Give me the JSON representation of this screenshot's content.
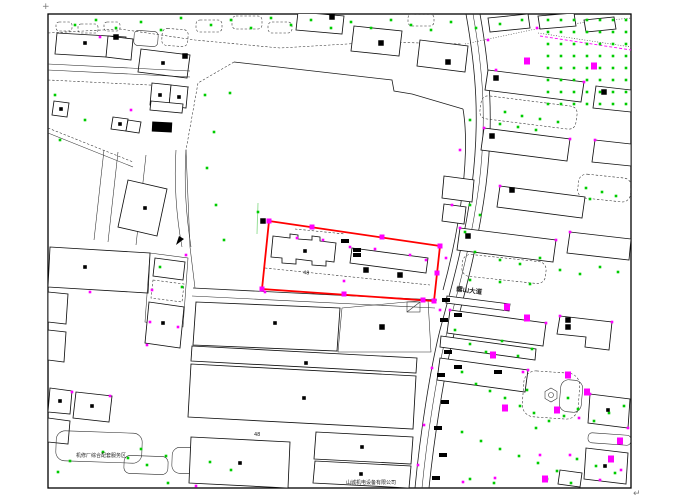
{
  "colors": {
    "background": "#ffffff",
    "line": "#1c1c1c",
    "parcel_red": "#ff0000",
    "tree_green": "#00cc00",
    "faint_green": "#8fdc8f",
    "marker_magenta": "#ff00ff",
    "text_dark": "#222222"
  },
  "labels": {
    "corner_plus": "+",
    "corner_return": "↵",
    "road_name": "螺山大道",
    "dim_a": "48",
    "dim_b": "48",
    "text_bottom_left": "机修厂综合配套服务区",
    "text_bottom_center": "山城机电设备有限公司"
  },
  "map": {
    "red_parcel": {
      "points_str": "269,221 440,246 434,301 262,289",
      "grips": [
        [
          269,
          221
        ],
        [
          312,
          227
        ],
        [
          382,
          237
        ],
        [
          440,
          246
        ],
        [
          437,
          273
        ],
        [
          434,
          301
        ],
        [
          423,
          300
        ],
        [
          344,
          294
        ],
        [
          262,
          289
        ]
      ]
    },
    "green_dots": [
      [
        548,
        20
      ],
      [
        561,
        20
      ],
      [
        574,
        20
      ],
      [
        587,
        20
      ],
      [
        600,
        20
      ],
      [
        613,
        20
      ],
      [
        626,
        20
      ],
      [
        548,
        32
      ],
      [
        561,
        32
      ],
      [
        574,
        32
      ],
      [
        587,
        32
      ],
      [
        600,
        32
      ],
      [
        613,
        32
      ],
      [
        626,
        32
      ],
      [
        548,
        44
      ],
      [
        561,
        44
      ],
      [
        574,
        44
      ],
      [
        587,
        44
      ],
      [
        600,
        44
      ],
      [
        613,
        44
      ],
      [
        626,
        44
      ],
      [
        548,
        56
      ],
      [
        561,
        56
      ],
      [
        574,
        56
      ],
      [
        587,
        56
      ],
      [
        600,
        56
      ],
      [
        613,
        56
      ],
      [
        626,
        56
      ],
      [
        548,
        68
      ],
      [
        561,
        68
      ],
      [
        574,
        68
      ],
      [
        587,
        68
      ],
      [
        600,
        68
      ],
      [
        613,
        68
      ],
      [
        626,
        68
      ],
      [
        548,
        80
      ],
      [
        561,
        80
      ],
      [
        574,
        80
      ],
      [
        587,
        80
      ],
      [
        600,
        80
      ],
      [
        613,
        80
      ],
      [
        626,
        80
      ],
      [
        548,
        92
      ],
      [
        561,
        92
      ],
      [
        574,
        92
      ],
      [
        587,
        92
      ],
      [
        600,
        92
      ],
      [
        613,
        92
      ],
      [
        626,
        92
      ],
      [
        548,
        104
      ],
      [
        561,
        104
      ],
      [
        574,
        104
      ],
      [
        587,
        104
      ],
      [
        600,
        104
      ],
      [
        613,
        104
      ],
      [
        626,
        104
      ],
      [
        505,
        112
      ],
      [
        522,
        116
      ],
      [
        540,
        119
      ],
      [
        558,
        122
      ],
      [
        500,
        124
      ],
      [
        518,
        127
      ],
      [
        536,
        130
      ],
      [
        470,
        120
      ],
      [
        586,
        188
      ],
      [
        602,
        192
      ],
      [
        616,
        196
      ],
      [
        590,
        199
      ],
      [
        470,
        205
      ],
      [
        480,
        215
      ],
      [
        465,
        232
      ],
      [
        475,
        252
      ],
      [
        500,
        260
      ],
      [
        520,
        264
      ],
      [
        540,
        258
      ],
      [
        560,
        270
      ],
      [
        580,
        274
      ],
      [
        600,
        267
      ],
      [
        618,
        272
      ],
      [
        470,
        280
      ],
      [
        500,
        282
      ],
      [
        530,
        284
      ],
      [
        455,
        330
      ],
      [
        470,
        344
      ],
      [
        486,
        352
      ],
      [
        502,
        341
      ],
      [
        518,
        356
      ],
      [
        532,
        349
      ],
      [
        462,
        372
      ],
      [
        476,
        384
      ],
      [
        490,
        391
      ],
      [
        505,
        398
      ],
      [
        520,
        406
      ],
      [
        534,
        413
      ],
      [
        549,
        421
      ],
      [
        564,
        416
      ],
      [
        578,
        409
      ],
      [
        594,
        421
      ],
      [
        609,
        413
      ],
      [
        624,
        406
      ],
      [
        527,
        390
      ],
      [
        536,
        428
      ],
      [
        568,
        398
      ],
      [
        462,
        432
      ],
      [
        481,
        441
      ],
      [
        500,
        449
      ],
      [
        519,
        456
      ],
      [
        538,
        463
      ],
      [
        557,
        471
      ],
      [
        577,
        459
      ],
      [
        596,
        466
      ],
      [
        615,
        473
      ],
      [
        470,
        479
      ],
      [
        494,
        483
      ],
      [
        547,
        479
      ],
      [
        571,
        483
      ],
      [
        70,
        461
      ],
      [
        103,
        452
      ],
      [
        141,
        449
      ],
      [
        147,
        465
      ],
      [
        166,
        456
      ],
      [
        210,
        462
      ],
      [
        231,
        470
      ],
      [
        160,
        267
      ],
      [
        182,
        287
      ],
      [
        168,
        483
      ],
      [
        58,
        472
      ],
      [
        128,
        458
      ],
      [
        205,
        95
      ],
      [
        214,
        132
      ],
      [
        207,
        168
      ],
      [
        216,
        205
      ],
      [
        224,
        240
      ],
      [
        258,
        212
      ],
      [
        230,
        93
      ],
      [
        75,
        25
      ],
      [
        96,
        20
      ],
      [
        116,
        28
      ],
      [
        141,
        22
      ],
      [
        161,
        30
      ],
      [
        181,
        18
      ],
      [
        211,
        25
      ],
      [
        231,
        20
      ],
      [
        251,
        28
      ],
      [
        271,
        18
      ],
      [
        291,
        25
      ],
      [
        311,
        20
      ],
      [
        331,
        28
      ],
      [
        351,
        22
      ],
      [
        371,
        28
      ],
      [
        391,
        20
      ],
      [
        411,
        25
      ],
      [
        431,
        30
      ],
      [
        451,
        22
      ],
      [
        476,
        28
      ],
      [
        500,
        24
      ],
      [
        522,
        20
      ],
      [
        55,
        95
      ],
      [
        85,
        120
      ],
      [
        60,
        140
      ]
    ],
    "magenta_ticks": [
      [
        297,
        238
      ],
      [
        323,
        240
      ],
      [
        375,
        249
      ],
      [
        410,
        255
      ],
      [
        350,
        247
      ],
      [
        426,
        260
      ],
      [
        265,
        292
      ],
      [
        488,
        40
      ],
      [
        537,
        28
      ],
      [
        460,
        150
      ],
      [
        452,
        205
      ],
      [
        446,
        258
      ],
      [
        440,
        310
      ],
      [
        432,
        368
      ],
      [
        424,
        425
      ],
      [
        418,
        465
      ],
      [
        496,
        70
      ],
      [
        584,
        82
      ],
      [
        484,
        128
      ],
      [
        570,
        139
      ],
      [
        595,
        140
      ],
      [
        500,
        186
      ],
      [
        460,
        228
      ],
      [
        556,
        240
      ],
      [
        570,
        232
      ],
      [
        450,
        310
      ],
      [
        546,
        323
      ],
      [
        528,
        370
      ],
      [
        560,
        316
      ],
      [
        612,
        322
      ],
      [
        523,
        372
      ],
      [
        579,
        418
      ],
      [
        590,
        394
      ],
      [
        628,
        428
      ],
      [
        152,
        290
      ],
      [
        186,
        255
      ],
      [
        90,
        292
      ],
      [
        150,
        322
      ],
      [
        100,
        37
      ],
      [
        131,
        110
      ],
      [
        178,
        327
      ],
      [
        147,
        345
      ],
      [
        110,
        396
      ],
      [
        72,
        392
      ],
      [
        540,
        455
      ],
      [
        570,
        455
      ],
      [
        600,
        480
      ],
      [
        621,
        470
      ],
      [
        495,
        478
      ],
      [
        463,
        482
      ],
      [
        196,
        486
      ],
      [
        344,
        281
      ]
    ],
    "magenta_blobs": [
      [
        594,
        66
      ],
      [
        527,
        61
      ],
      [
        507,
        307
      ],
      [
        527,
        318
      ],
      [
        493,
        355
      ],
      [
        568,
        375
      ],
      [
        587,
        392
      ],
      [
        557,
        410
      ],
      [
        505,
        408
      ],
      [
        620,
        441
      ],
      [
        611,
        459
      ],
      [
        545,
        479
      ]
    ],
    "black_dots": [
      [
        85,
        43
      ],
      [
        163,
        63
      ],
      [
        61,
        109
      ],
      [
        160,
        95
      ],
      [
        179,
        97
      ],
      [
        120,
        124
      ],
      [
        145,
        208
      ],
      [
        85,
        267
      ],
      [
        92,
        406
      ],
      [
        60,
        401
      ],
      [
        163,
        323
      ],
      [
        275,
        323
      ],
      [
        306,
        363
      ],
      [
        304,
        398
      ],
      [
        240,
        463
      ],
      [
        362,
        447
      ],
      [
        361,
        474
      ],
      [
        305,
        251
      ],
      [
        608,
        410
      ],
      [
        605,
        466
      ]
    ],
    "black_squares": [
      [
        116,
        37
      ],
      [
        185,
        56
      ],
      [
        332,
        17
      ],
      [
        381,
        43
      ],
      [
        448,
        62
      ],
      [
        496,
        78
      ],
      [
        604,
        92
      ],
      [
        492,
        136
      ],
      [
        468,
        236
      ],
      [
        263,
        221
      ],
      [
        366,
        270
      ],
      [
        400,
        275
      ],
      [
        382,
        327
      ],
      [
        512,
        190
      ],
      [
        568,
        320
      ],
      [
        568,
        327
      ]
    ],
    "black_cars": [
      [
        345,
        241
      ],
      [
        357,
        250
      ],
      [
        357,
        255
      ],
      [
        446,
        300
      ],
      [
        444,
        320
      ],
      [
        448,
        352
      ],
      [
        441,
        375
      ],
      [
        445,
        402
      ],
      [
        438,
        428
      ],
      [
        443,
        455
      ],
      [
        436,
        478
      ],
      [
        458,
        315
      ],
      [
        458,
        367
      ],
      [
        498,
        372
      ]
    ]
  }
}
